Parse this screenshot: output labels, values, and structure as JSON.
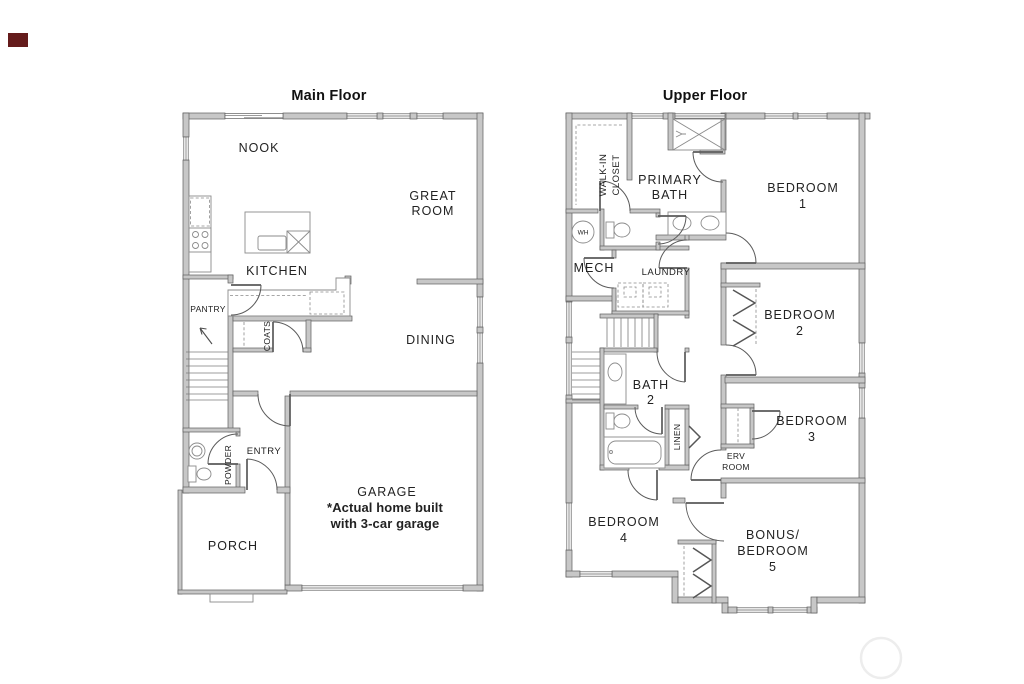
{
  "colors": {
    "background": "#ffffff",
    "wall-fill": "#c7c7c7",
    "wall-stroke": "#5e5e5e",
    "fixture-stroke": "#8b8b8b",
    "door-stroke": "#5a5a5a",
    "text": "#222222",
    "title-text": "#111111",
    "watermark": "#ededed",
    "corner-mark": "#641b1b"
  },
  "main_floor": {
    "title": "Main Floor",
    "labels": {
      "nook": "NOOK",
      "great_room_1": "GREAT",
      "great_room_2": "ROOM",
      "kitchen": "KITCHEN",
      "pantry": "PANTRY",
      "coats": "COATS",
      "dining": "DINING",
      "powder": "POWDER",
      "entry": "ENTRY",
      "garage": "GARAGE",
      "garage_note_1": "*Actual home built",
      "garage_note_2": "with 3-car garage",
      "porch": "PORCH"
    }
  },
  "upper_floor": {
    "title": "Upper Floor",
    "labels": {
      "walk_in_closet_1": "WALK-IN",
      "walk_in_closet_2": "CLOSET",
      "primary_bath_1": "PRIMARY",
      "primary_bath_2": "BATH",
      "bedroom_1_1": "BEDROOM",
      "bedroom_1_2": "1",
      "water_heater": "WH",
      "mech": "MECH",
      "laundry": "LAUNDRY",
      "bedroom_2_1": "BEDROOM",
      "bedroom_2_2": "2",
      "bath_2_1": "BATH",
      "bath_2_2": "2",
      "linen": "LINEN",
      "erv_room_1": "ERV",
      "erv_room_2": "ROOM",
      "bedroom_3_1": "BEDROOM",
      "bedroom_3_2": "3",
      "bedroom_4_1": "BEDROOM",
      "bedroom_4_2": "4",
      "bonus_1": "BONUS/",
      "bonus_2": "BEDROOM",
      "bonus_3": "5"
    }
  }
}
